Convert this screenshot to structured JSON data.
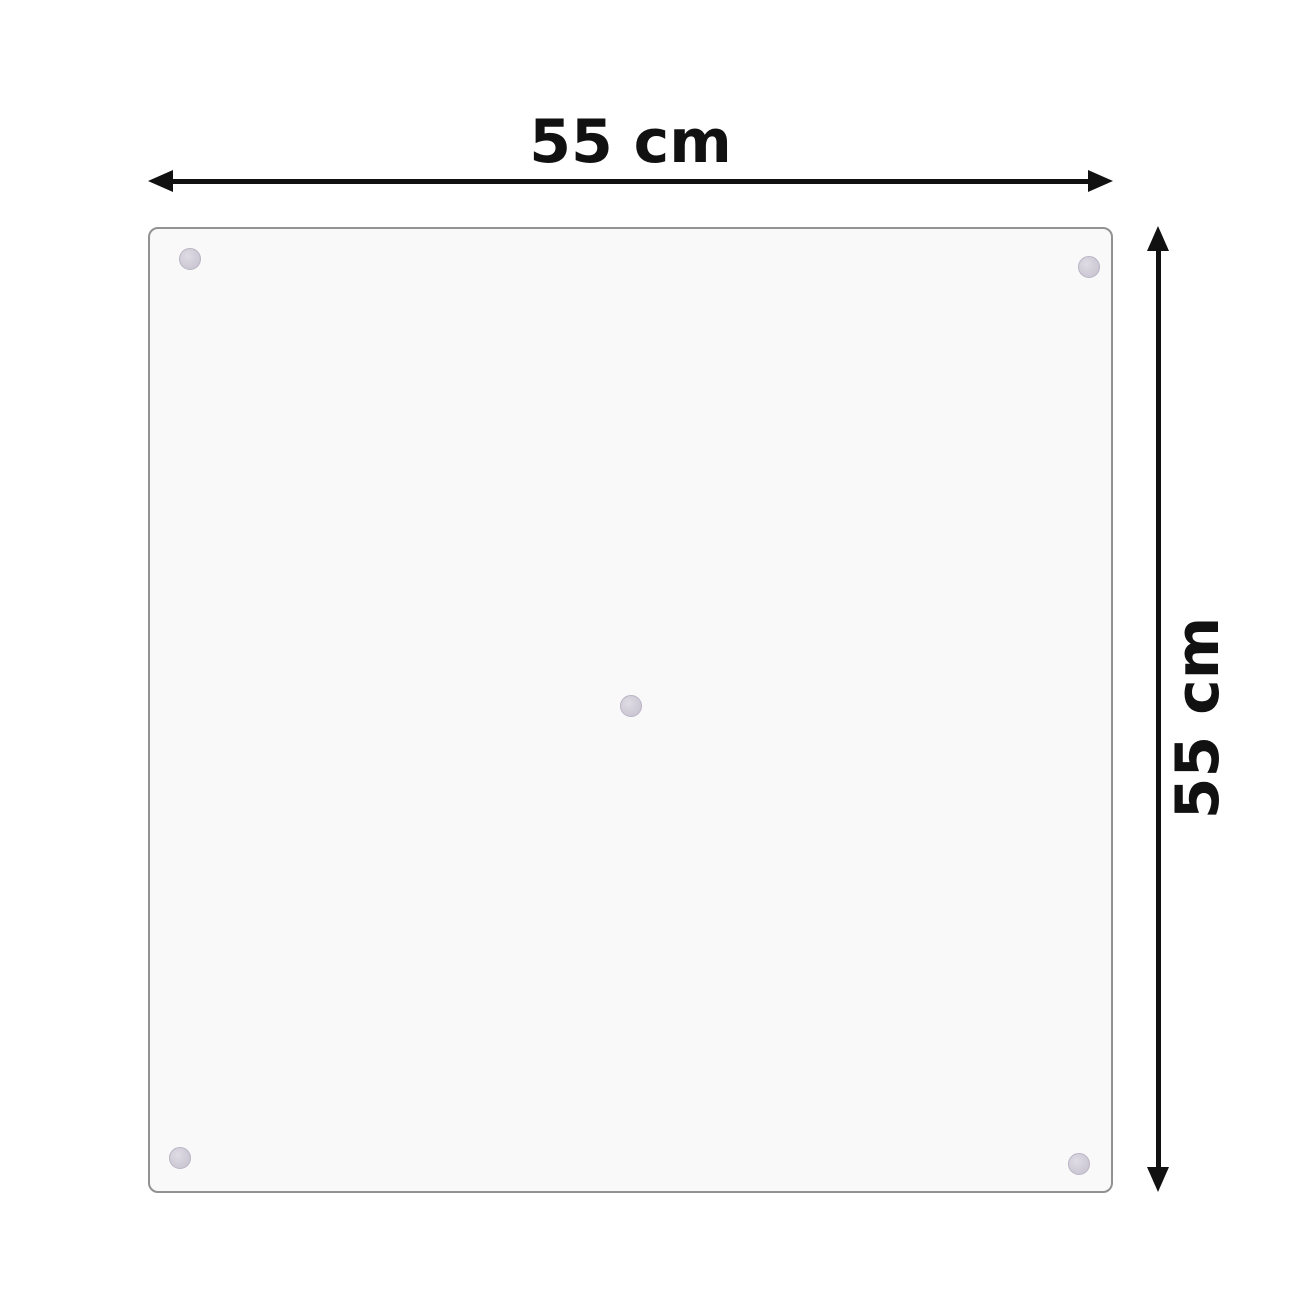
{
  "diagram": {
    "subject": "square glass panel with suction-cup mounts",
    "width_label": "55 cm",
    "height_label": "55 cm",
    "mount_dots": {
      "count": 5,
      "positions": [
        "top-left",
        "top-right",
        "center",
        "bottom-left",
        "bottom-right"
      ]
    },
    "colors": {
      "background": "#ffffff",
      "arrow": "#111111",
      "label_text": "#111111",
      "panel_border": "#929292",
      "panel_fill": "#f9f9fa",
      "dot_outer": "#c4bfcd",
      "dot_inner": "#dfdce5"
    }
  }
}
